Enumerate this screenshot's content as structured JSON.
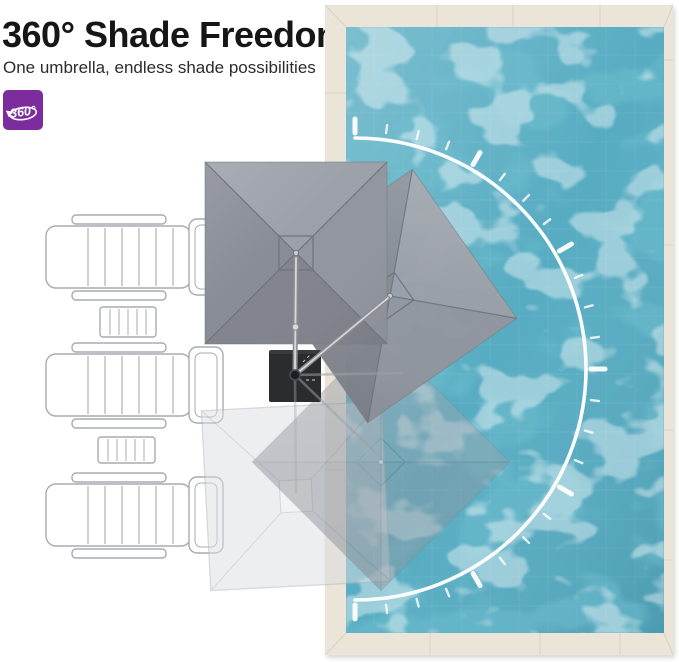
{
  "header": {
    "title": "360° Shade Freedom",
    "subtitle": "One umbrella, endless shade possibilities"
  },
  "badge": {
    "label": "360°",
    "icon": "rotate-360-icon",
    "background_color": "#7C2C9C"
  },
  "colors": {
    "water": "#57ACC2",
    "water_light": "#8FCBDA",
    "deck": "#EAE4D9",
    "deck_line": "#D8D1C3",
    "canopy": "#8E929B",
    "canopy_seam": "#6F727A",
    "ghost_canopy": "#DCDEE2",
    "pole": "#D6D8DB",
    "base": "#2A2C2E",
    "arc": "#FFFFFF"
  },
  "scene": {
    "pool": {
      "name": "swimming-pool-top-view"
    },
    "rotation_arc": {
      "shape": "semicircle",
      "start_deg": -90,
      "end_deg": 90,
      "minor_step_deg": 7.5,
      "major_step_deg": 30
    },
    "umbrellas": {
      "solid_count": 2,
      "ghost_count": 2
    },
    "loungers_count": 3,
    "side_tables_count": 2
  }
}
